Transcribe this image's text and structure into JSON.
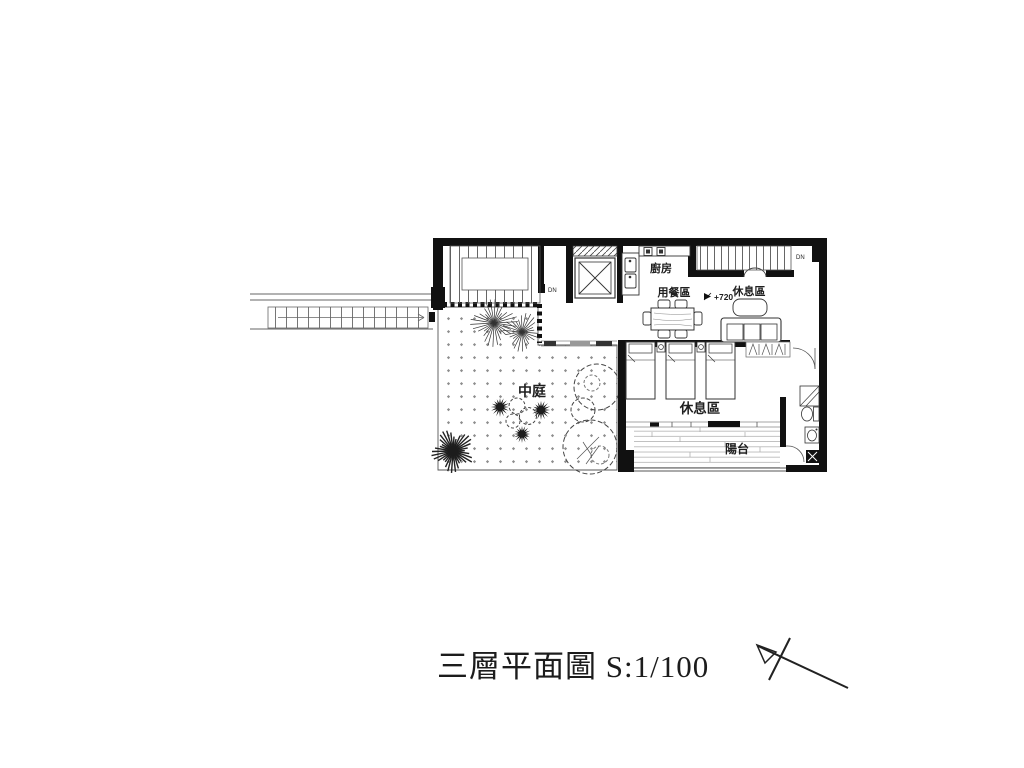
{
  "page": {
    "background_color": "#ffffff"
  },
  "drawing": {
    "title": "三層平面圖 S:1/100",
    "labels": {
      "kitchen": "廚房",
      "dining": "用餐區",
      "lounge_upper": "休息區",
      "courtyard": "中庭",
      "lounge_bedroom": "休息區",
      "balcony": "陽台"
    },
    "annotations": {
      "elevation": "+720",
      "stair_left_down": "DN",
      "stair_right_down": "DN"
    },
    "colors": {
      "wall": "#111111",
      "thin_line": "#444444",
      "pattern_dot": "#8d8d8d",
      "text": "#1f1f1f",
      "background": "#ffffff"
    }
  }
}
